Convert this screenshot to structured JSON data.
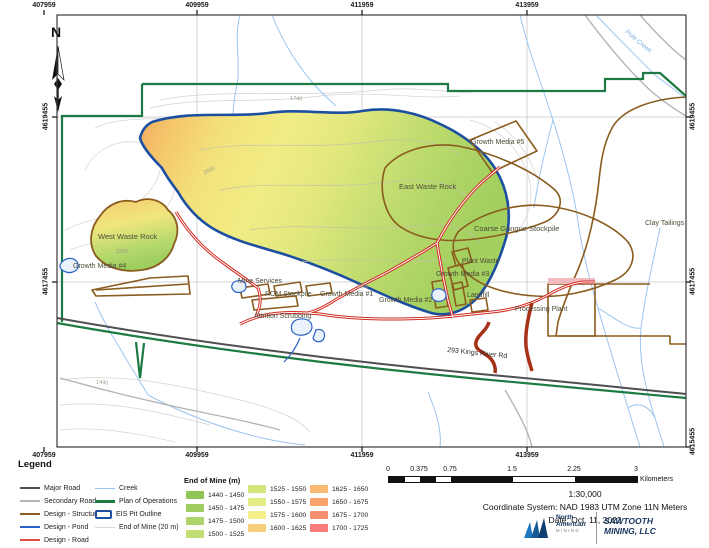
{
  "map": {
    "north_label": "N",
    "axis": {
      "eastings": [
        "407959",
        "409959",
        "411959",
        "413959"
      ],
      "northings": [
        "4619455",
        "4617455",
        "4615455"
      ]
    },
    "labels": {
      "west_waste_rock": "West Waste Rock",
      "growth_media_4": "Growth Media #4",
      "mine_services": "Mine Services",
      "rom_stockpile": "ROM Stockpile",
      "attrition_scrubbing": "Attrition Scrubbing",
      "growth_media_1": "Growth Media #1",
      "growth_media_2": "Growth Media #2",
      "growth_media_3": "Growth Media #3",
      "plant_waste": "Plant Waste",
      "landfill": "Landfill",
      "east_waste_rock": "East Waste Rock",
      "growth_media_5": "Growth Media #5",
      "coarse_gangue_stockpile": "Coarse Gangue Stockpile",
      "processing_plant": "Processing Plant",
      "clay_tailings": "Clay Tailings",
      "kings_river_rd": "293 Kings River Rd",
      "pole_creek": "Pole Creek"
    },
    "contour_labels": [
      "1740",
      "1600",
      "1500",
      "1560",
      "1440"
    ]
  },
  "legend": {
    "title": "Legend",
    "lines_col1": [
      {
        "label": "Major Road",
        "color": "#4f4f4f"
      },
      {
        "label": "Secondary Road",
        "color": "#b4b4b4"
      },
      {
        "label": "Design - Structure",
        "color": "#8a5c1e"
      },
      {
        "label": "Design - Pond",
        "color": "#2b62c9"
      },
      {
        "label": "Design - Road",
        "color": "#e04a42"
      }
    ],
    "lines_col2": [
      {
        "label": "Creek",
        "color": "#9cc5ee"
      },
      {
        "label": "Plan of Operations",
        "color": "#1c7a42"
      },
      {
        "label": "EIS Pit Outline",
        "color": "#1c4fa0"
      },
      {
        "label": "End of Mine (20 m)",
        "color": "#d8d8d8"
      }
    ],
    "ramp_title": "End of Mine (m)",
    "ramp": [
      {
        "label": "1440 - 1450",
        "color": "#90c653"
      },
      {
        "label": "1450 - 1475",
        "color": "#9fcc5f"
      },
      {
        "label": "1475 - 1500",
        "color": "#afd46b"
      },
      {
        "label": "1500 - 1525",
        "color": "#c1dd74"
      },
      {
        "label": "1525 - 1550",
        "color": "#d2e47c"
      },
      {
        "label": "1550 - 1575",
        "color": "#e3eb84"
      },
      {
        "label": "1575 - 1600",
        "color": "#f3f08c"
      },
      {
        "label": "1600 - 1625",
        "color": "#f8cf7c"
      },
      {
        "label": "1625 - 1650",
        "color": "#f8ba72"
      },
      {
        "label": "1650 - 1675",
        "color": "#f8a46c"
      },
      {
        "label": "1675 - 1700",
        "color": "#f88f70"
      },
      {
        "label": "1700 - 1725",
        "color": "#f87c7a"
      }
    ]
  },
  "scalebar": {
    "ticks": [
      "0",
      "0.375",
      "0.75",
      "1.5",
      "2.25",
      "3"
    ],
    "unit": "Kilometers"
  },
  "footer": {
    "scale_text": "1:30,000",
    "coord_system": "Coordinate System: NAD 1983 UTM Zone 11N Meters",
    "date": "Date: Oct. 11, 2022"
  },
  "branding": {
    "nam_line1": "North",
    "nam_line2": "American",
    "nam_sub": "MINING",
    "sawtooth_line1": "SAWTOOTH",
    "sawtooth_line2": "MINING, LLC"
  }
}
